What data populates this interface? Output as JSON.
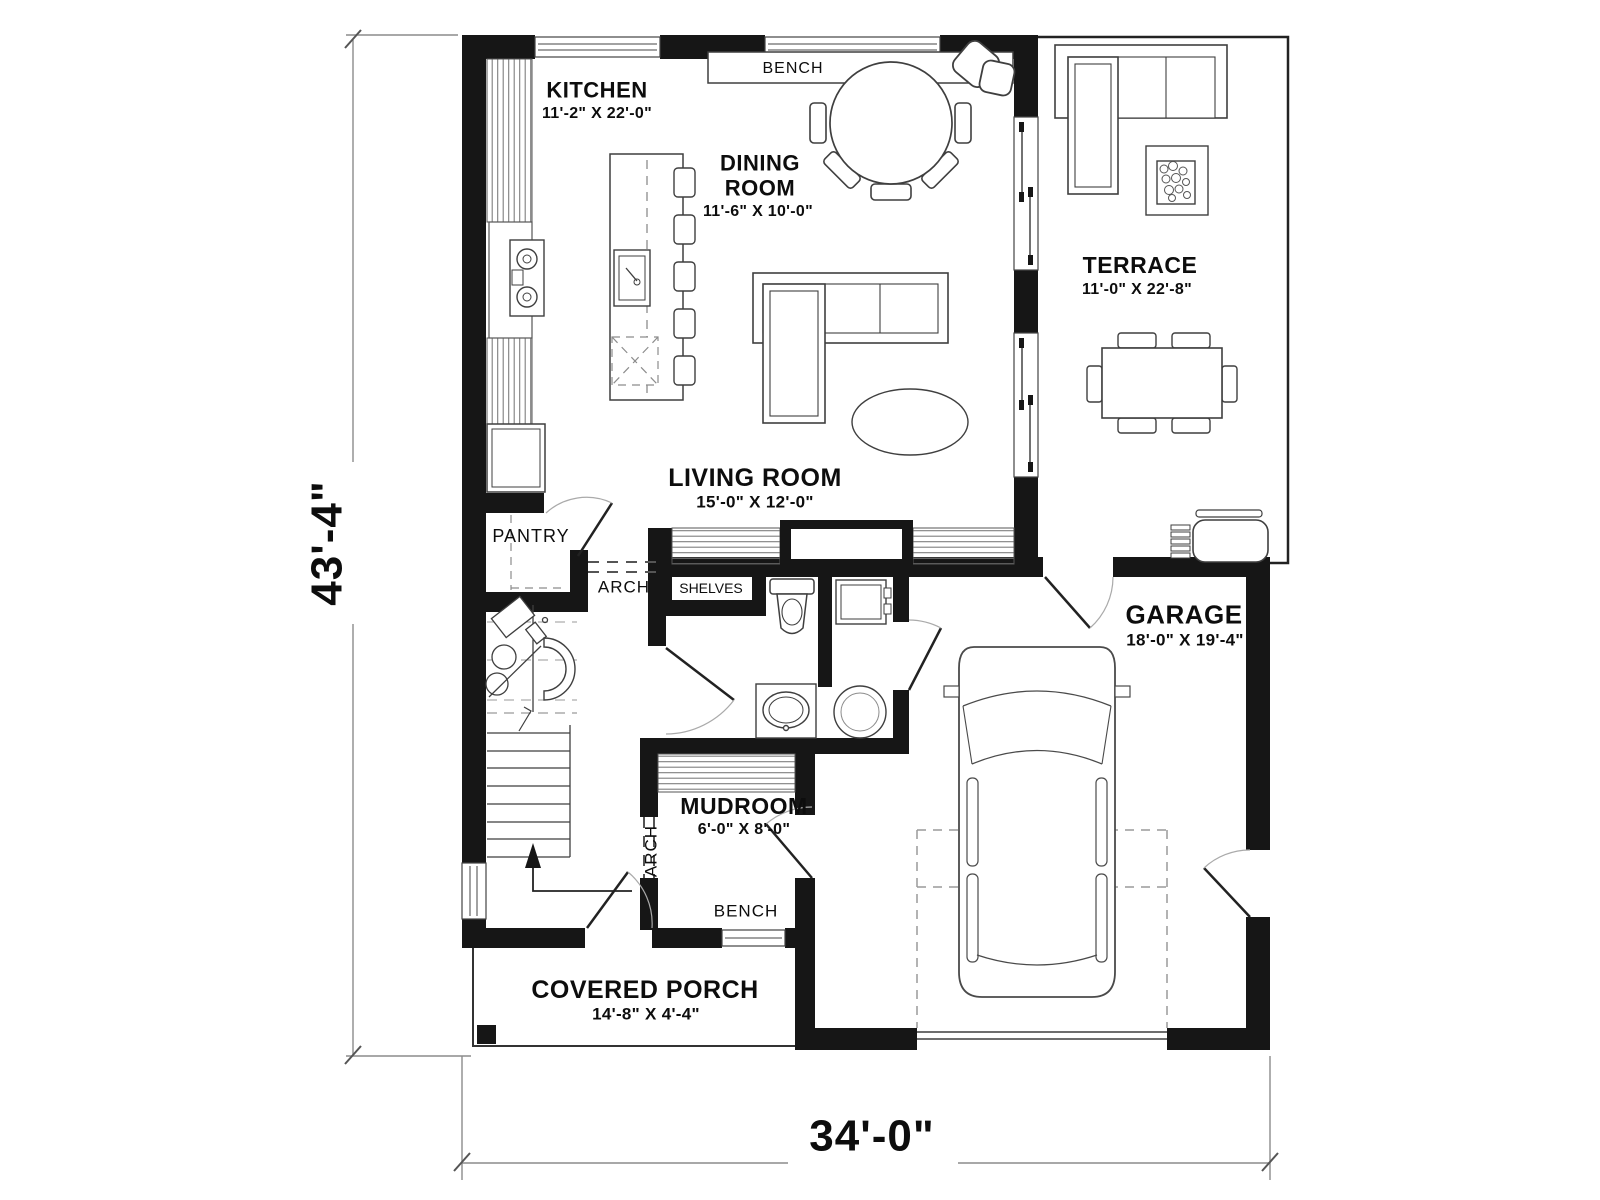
{
  "plan": {
    "title": "house-first-floor-plan",
    "rooms": {
      "kitchen": {
        "label": "KITCHEN",
        "size": "11'-2\" X 22'-0\""
      },
      "dining": {
        "label": "DINING ROOM",
        "size": "11'-6\" X 10'-0\""
      },
      "terrace": {
        "label": "TERRACE",
        "size": "11'-0\" X 22'-8\""
      },
      "living": {
        "label": "LIVING ROOM",
        "size": "15'-0\" X 12'-0\""
      },
      "pantry": {
        "label": "PANTRY"
      },
      "garage": {
        "label": "GARAGE",
        "size": "18'-0\" X 19'-4\""
      },
      "mudroom": {
        "label": "MUDROOM",
        "size": "6'-0\" X 8'-0\""
      },
      "covered_porch": {
        "label": "COVERED PORCH",
        "size": "14'-8\" X 4'-4\""
      }
    },
    "annotations": {
      "bench_dining": "BENCH",
      "bench_mudroom": "BENCH",
      "arch_hall": "ARCH",
      "arch_mudroom": "ARCH",
      "shelves": "SHELVES"
    },
    "dimensions": {
      "overall_depth": "43'-4\"",
      "overall_width": "34'-0\""
    },
    "colors": {
      "walls": "#161616",
      "lines": "#3f3f3f",
      "hatch": "#7d7d7d",
      "dimension_lines": "#8c8c8c",
      "background": "#ffffff"
    }
  }
}
